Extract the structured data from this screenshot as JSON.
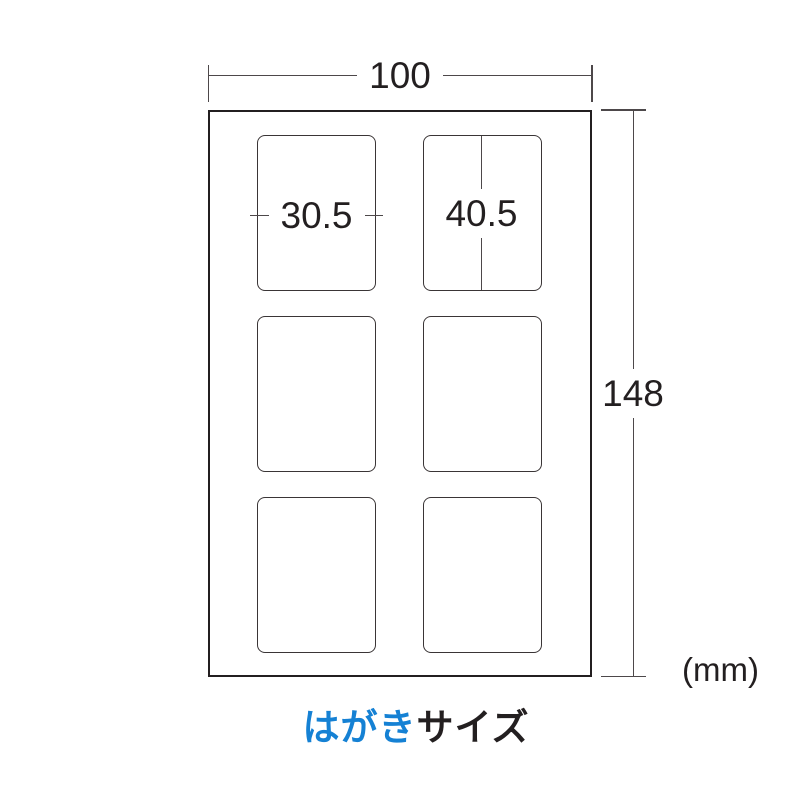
{
  "dims": {
    "sheet_width": "100",
    "sheet_height": "148",
    "label_width": "30.5",
    "label_height": "40.5",
    "unit": "(mm)"
  },
  "caption": {
    "highlight": "はがき",
    "rest": "サイズ"
  },
  "grid": {
    "rows": 3,
    "cols": 2
  },
  "colors": {
    "accent_blue": "#1581d4",
    "line": "#4d484a",
    "text": "#231f20",
    "sheet_border": "#231f20",
    "cell_border": "#3a3536",
    "background": "#ffffff"
  }
}
